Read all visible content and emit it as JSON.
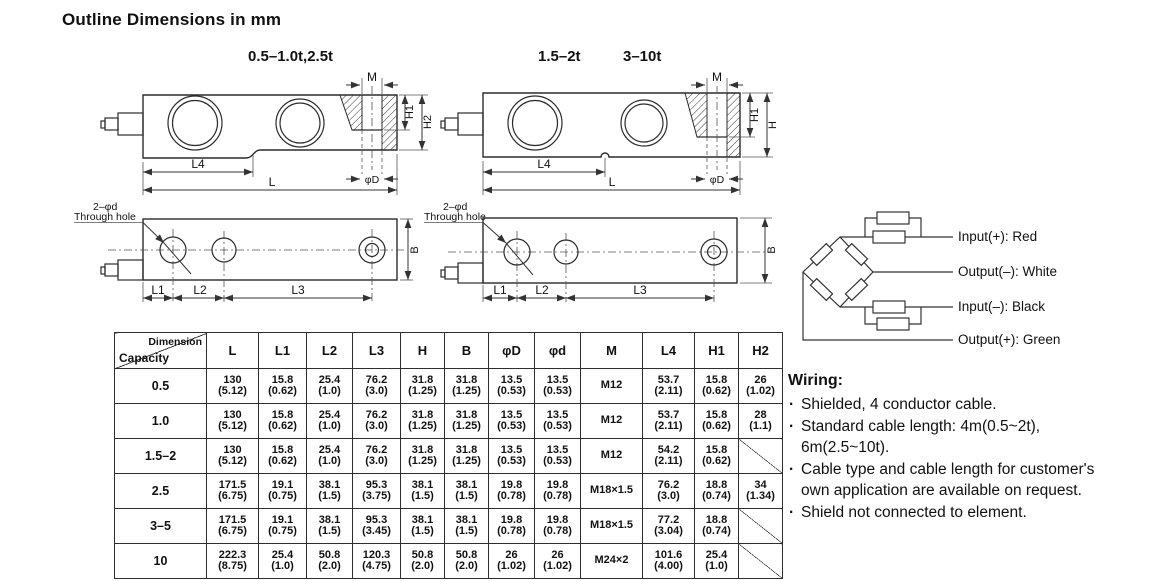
{
  "page": {
    "title": "Outline Dimensions in mm"
  },
  "drawings": {
    "side_a": {
      "caption": "0.5–1.0t,2.5t",
      "labels": {
        "m": "M",
        "h1": "H1",
        "h2": "H2",
        "l4": "L4",
        "l": "L",
        "phi_d": "φD"
      }
    },
    "side_b": {
      "caption_1": "1.5–2t",
      "caption_2": "3–10t",
      "labels": {
        "m": "M",
        "h1": "H1",
        "h": "H",
        "l4": "L4",
        "l": "L",
        "phi_d": "φD"
      }
    },
    "top_a": {
      "labels": {
        "hole_note_line1": "2–φd",
        "hole_note_line2": "Through hole",
        "b": "B",
        "l1": "L1",
        "l2": "L2",
        "l3": "L3"
      }
    },
    "top_b": {
      "labels": {
        "hole_note_line1": "2–φd",
        "hole_note_line2": "Through hole",
        "b": "B",
        "l1": "L1",
        "l2": "L2",
        "l3": "L3"
      }
    },
    "bridge": {
      "labels": [
        "Input(+): Red",
        "Output(–): White",
        "Input(–): Black",
        "Output(+): Green"
      ]
    }
  },
  "table": {
    "corner": {
      "top": "Dimension",
      "bottom": "Capacity"
    },
    "columns": [
      "L",
      "L1",
      "L2",
      "L3",
      "H",
      "B",
      "φD",
      "φd",
      "M",
      "L4",
      "H1",
      "H2"
    ],
    "rows": [
      {
        "capacity": "0.5",
        "cells": [
          [
            "130",
            "(5.12)"
          ],
          [
            "15.8",
            "(0.62)"
          ],
          [
            "25.4",
            "(1.0)"
          ],
          [
            "76.2",
            "(3.0)"
          ],
          [
            "31.8",
            "(1.25)"
          ],
          [
            "31.8",
            "(1.25)"
          ],
          [
            "13.5",
            "(0.53)"
          ],
          [
            "13.5",
            "(0.53)"
          ],
          [
            "M12"
          ],
          [
            "53.7",
            "(2.11)"
          ],
          [
            "15.8",
            "(0.62)"
          ],
          [
            "26",
            "(1.02)"
          ]
        ]
      },
      {
        "capacity": "1.0",
        "cells": [
          [
            "130",
            "(5.12)"
          ],
          [
            "15.8",
            "(0.62)"
          ],
          [
            "25.4",
            "(1.0)"
          ],
          [
            "76.2",
            "(3.0)"
          ],
          [
            "31.8",
            "(1.25)"
          ],
          [
            "31.8",
            "(1.25)"
          ],
          [
            "13.5",
            "(0.53)"
          ],
          [
            "13.5",
            "(0.53)"
          ],
          [
            "M12"
          ],
          [
            "53.7",
            "(2.11)"
          ],
          [
            "15.8",
            "(0.62)"
          ],
          [
            "28",
            "(1.1)"
          ]
        ]
      },
      {
        "capacity": "1.5–2",
        "cells": [
          [
            "130",
            "(5.12)"
          ],
          [
            "15.8",
            "(0.62)"
          ],
          [
            "25.4",
            "(1.0)"
          ],
          [
            "76.2",
            "(3.0)"
          ],
          [
            "31.8",
            "(1.25)"
          ],
          [
            "31.8",
            "(1.25)"
          ],
          [
            "13.5",
            "(0.53)"
          ],
          [
            "13.5",
            "(0.53)"
          ],
          [
            "M12"
          ],
          [
            "54.2",
            "(2.11)"
          ],
          [
            "15.8",
            "(0.62)"
          ],
          null
        ]
      },
      {
        "capacity": "2.5",
        "cells": [
          [
            "171.5",
            "(6.75)"
          ],
          [
            "19.1",
            "(0.75)"
          ],
          [
            "38.1",
            "(1.5)"
          ],
          [
            "95.3",
            "(3.75)"
          ],
          [
            "38.1",
            "(1.5)"
          ],
          [
            "38.1",
            "(1.5)"
          ],
          [
            "19.8",
            "(0.78)"
          ],
          [
            "19.8",
            "(0.78)"
          ],
          [
            "M18×1.5"
          ],
          [
            "76.2",
            "(3.0)"
          ],
          [
            "18.8",
            "(0.74)"
          ],
          [
            "34",
            "(1.34)"
          ]
        ]
      },
      {
        "capacity": "3–5",
        "cells": [
          [
            "171.5",
            "(6.75)"
          ],
          [
            "19.1",
            "(0.75)"
          ],
          [
            "38.1",
            "(1.5)"
          ],
          [
            "95.3",
            "(3.45)"
          ],
          [
            "38.1",
            "(1.5)"
          ],
          [
            "38.1",
            "(1.5)"
          ],
          [
            "19.8",
            "(0.78)"
          ],
          [
            "19.8",
            "(0.78)"
          ],
          [
            "M18×1.5"
          ],
          [
            "77.2",
            "(3.04)"
          ],
          [
            "18.8",
            "(0.74)"
          ],
          null
        ]
      },
      {
        "capacity": "10",
        "cells": [
          [
            "222.3",
            "(8.75)"
          ],
          [
            "25.4",
            "(1.0)"
          ],
          [
            "50.8",
            "(2.0)"
          ],
          [
            "120.3",
            "(4.75)"
          ],
          [
            "50.8",
            "(2.0)"
          ],
          [
            "50.8",
            "(2.0)"
          ],
          [
            "26",
            "(1.02)"
          ],
          [
            "26",
            "(1.02)"
          ],
          [
            "M24×2"
          ],
          [
            "101.6",
            "(4.00)"
          ],
          [
            "25.4",
            "(1.0)"
          ],
          null
        ]
      }
    ]
  },
  "wiring": {
    "heading": "Wiring:",
    "notes": [
      "Shielded, 4 conductor cable.",
      "Standard cable length: 4m(0.5~2t), 6m(2.5~10t).",
      "Cable type and cable length for customer's own application are available on request.",
      "Shield not connected to element."
    ]
  }
}
